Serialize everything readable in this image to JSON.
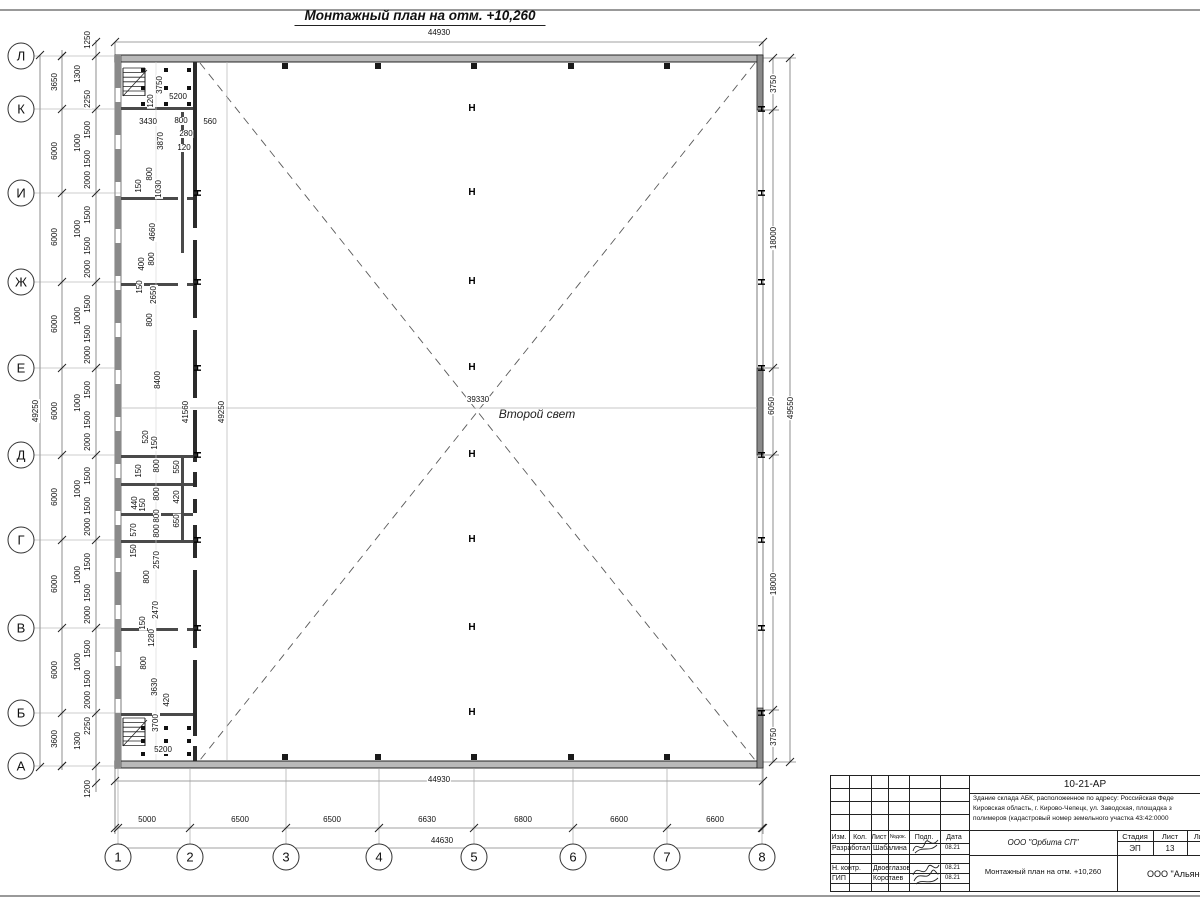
{
  "sheet": {
    "title": "Монтажный план на отм. +10,260"
  },
  "plan": {
    "hall_label": "Второй свет",
    "column_symbol": "H",
    "axis_rows": [
      {
        "label": "Л",
        "y": 56
      },
      {
        "label": "К",
        "y": 109
      },
      {
        "label": "И",
        "y": 193
      },
      {
        "label": "Ж",
        "y": 282
      },
      {
        "label": "Е",
        "y": 368
      },
      {
        "label": "Д",
        "y": 455
      },
      {
        "label": "Г",
        "y": 540
      },
      {
        "label": "В",
        "y": 628
      },
      {
        "label": "Б",
        "y": 713
      },
      {
        "label": "А",
        "y": 766
      }
    ],
    "axis_cols": [
      {
        "label": "1",
        "x": 118
      },
      {
        "label": "2",
        "x": 190
      },
      {
        "label": "3",
        "x": 286
      },
      {
        "label": "4",
        "x": 379
      },
      {
        "label": "5",
        "x": 474
      },
      {
        "label": "6",
        "x": 573
      },
      {
        "label": "7",
        "x": 667
      },
      {
        "label": "8",
        "x": 762
      }
    ],
    "dim_labels_h": [
      {
        "t": "44930",
        "x": 439,
        "y": 33
      },
      {
        "t": "5200",
        "x": 178,
        "y": 97
      },
      {
        "t": "3430",
        "x": 148,
        "y": 122
      },
      {
        "t": "800",
        "x": 181,
        "y": 121
      },
      {
        "t": "560",
        "x": 210,
        "y": 122
      },
      {
        "t": "280",
        "x": 186,
        "y": 134
      },
      {
        "t": "120",
        "x": 184,
        "y": 148
      },
      {
        "t": "39330",
        "x": 478,
        "y": 400
      },
      {
        "t": "5200",
        "x": 163,
        "y": 750
      },
      {
        "t": "44930",
        "x": 439,
        "y": 780
      },
      {
        "t": "5000",
        "x": 147,
        "y": 820
      },
      {
        "t": "6500",
        "x": 240,
        "y": 820
      },
      {
        "t": "6500",
        "x": 332,
        "y": 820
      },
      {
        "t": "6630",
        "x": 427,
        "y": 820
      },
      {
        "t": "6800",
        "x": 523,
        "y": 820
      },
      {
        "t": "6600",
        "x": 619,
        "y": 820
      },
      {
        "t": "6600",
        "x": 715,
        "y": 820
      },
      {
        "t": "44630",
        "x": 442,
        "y": 841
      }
    ],
    "dim_labels_v": [
      {
        "t": "49250",
        "x": 36,
        "y": 411
      },
      {
        "t": "3650",
        "x": 55,
        "y": 82
      },
      {
        "t": "6000",
        "x": 55,
        "y": 151
      },
      {
        "t": "6000",
        "x": 55,
        "y": 237
      },
      {
        "t": "6000",
        "x": 55,
        "y": 324
      },
      {
        "t": "6000",
        "x": 55,
        "y": 411
      },
      {
        "t": "6000",
        "x": 55,
        "y": 497
      },
      {
        "t": "6000",
        "x": 55,
        "y": 584
      },
      {
        "t": "6000",
        "x": 55,
        "y": 670
      },
      {
        "t": "3600",
        "x": 55,
        "y": 739
      },
      {
        "t": "1250",
        "x": 88,
        "y": 40
      },
      {
        "t": "1300",
        "x": 78,
        "y": 74
      },
      {
        "t": "2250",
        "x": 88,
        "y": 99
      },
      {
        "t": "1500",
        "x": 88,
        "y": 130
      },
      {
        "t": "1000",
        "x": 78,
        "y": 143
      },
      {
        "t": "1500",
        "x": 88,
        "y": 159
      },
      {
        "t": "2000",
        "x": 88,
        "y": 180
      },
      {
        "t": "1500",
        "x": 88,
        "y": 215
      },
      {
        "t": "1000",
        "x": 78,
        "y": 229
      },
      {
        "t": "1500",
        "x": 88,
        "y": 246
      },
      {
        "t": "2000",
        "x": 88,
        "y": 269
      },
      {
        "t": "1500",
        "x": 88,
        "y": 304
      },
      {
        "t": "1000",
        "x": 78,
        "y": 316
      },
      {
        "t": "1500",
        "x": 88,
        "y": 334
      },
      {
        "t": "2000",
        "x": 88,
        "y": 355
      },
      {
        "t": "1500",
        "x": 88,
        "y": 390
      },
      {
        "t": "1000",
        "x": 78,
        "y": 403
      },
      {
        "t": "1500",
        "x": 88,
        "y": 420
      },
      {
        "t": "2000",
        "x": 88,
        "y": 442
      },
      {
        "t": "1500",
        "x": 88,
        "y": 476
      },
      {
        "t": "1000",
        "x": 78,
        "y": 489
      },
      {
        "t": "1500",
        "x": 88,
        "y": 506
      },
      {
        "t": "2000",
        "x": 88,
        "y": 527
      },
      {
        "t": "1500",
        "x": 88,
        "y": 562
      },
      {
        "t": "1000",
        "x": 78,
        "y": 575
      },
      {
        "t": "1500",
        "x": 88,
        "y": 593
      },
      {
        "t": "2000",
        "x": 88,
        "y": 615
      },
      {
        "t": "1500",
        "x": 88,
        "y": 649
      },
      {
        "t": "1000",
        "x": 78,
        "y": 662
      },
      {
        "t": "1500",
        "x": 88,
        "y": 679
      },
      {
        "t": "2000",
        "x": 88,
        "y": 700
      },
      {
        "t": "2250",
        "x": 88,
        "y": 726
      },
      {
        "t": "1300",
        "x": 78,
        "y": 741
      },
      {
        "t": "1200",
        "x": 88,
        "y": 789
      },
      {
        "t": "3750",
        "x": 774,
        "y": 84
      },
      {
        "t": "18000",
        "x": 774,
        "y": 238
      },
      {
        "t": "6050",
        "x": 772,
        "y": 406
      },
      {
        "t": "49550",
        "x": 791,
        "y": 408
      },
      {
        "t": "18000",
        "x": 774,
        "y": 584
      },
      {
        "t": "3750",
        "x": 774,
        "y": 737
      },
      {
        "t": "3750",
        "x": 160,
        "y": 85
      },
      {
        "t": "120",
        "x": 151,
        "y": 101
      },
      {
        "t": "3870",
        "x": 161,
        "y": 141
      },
      {
        "t": "800",
        "x": 150,
        "y": 174
      },
      {
        "t": "150",
        "x": 139,
        "y": 186
      },
      {
        "t": "1030",
        "x": 159,
        "y": 189
      },
      {
        "t": "4660",
        "x": 153,
        "y": 232
      },
      {
        "t": "400",
        "x": 142,
        "y": 264
      },
      {
        "t": "800",
        "x": 152,
        "y": 259
      },
      {
        "t": "150",
        "x": 140,
        "y": 287
      },
      {
        "t": "2650",
        "x": 154,
        "y": 295
      },
      {
        "t": "800",
        "x": 150,
        "y": 320
      },
      {
        "t": "8400",
        "x": 158,
        "y": 380
      },
      {
        "t": "41560",
        "x": 186,
        "y": 412
      },
      {
        "t": "49250",
        "x": 222,
        "y": 412
      },
      {
        "t": "520",
        "x": 146,
        "y": 437
      },
      {
        "t": "150",
        "x": 155,
        "y": 443
      },
      {
        "t": "800",
        "x": 157,
        "y": 466
      },
      {
        "t": "550",
        "x": 177,
        "y": 467
      },
      {
        "t": "150",
        "x": 139,
        "y": 471
      },
      {
        "t": "800",
        "x": 157,
        "y": 494
      },
      {
        "t": "420",
        "x": 177,
        "y": 497
      },
      {
        "t": "440",
        "x": 135,
        "y": 503
      },
      {
        "t": "150",
        "x": 143,
        "y": 505
      },
      {
        "t": "800",
        "x": 157,
        "y": 516
      },
      {
        "t": "650",
        "x": 177,
        "y": 521
      },
      {
        "t": "570",
        "x": 134,
        "y": 530
      },
      {
        "t": "800",
        "x": 157,
        "y": 531
      },
      {
        "t": "150",
        "x": 134,
        "y": 551
      },
      {
        "t": "2570",
        "x": 157,
        "y": 560
      },
      {
        "t": "800",
        "x": 147,
        "y": 577
      },
      {
        "t": "2470",
        "x": 156,
        "y": 610
      },
      {
        "t": "150",
        "x": 143,
        "y": 623
      },
      {
        "t": "1280",
        "x": 152,
        "y": 638
      },
      {
        "t": "800",
        "x": 144,
        "y": 663
      },
      {
        "t": "3630",
        "x": 155,
        "y": 687
      },
      {
        "t": "420",
        "x": 167,
        "y": 700
      },
      {
        "t": "3700",
        "x": 156,
        "y": 723
      }
    ],
    "center_columns": {
      "x": 472,
      "rows": [
        109,
        193,
        282,
        368,
        455,
        540,
        628,
        713
      ]
    },
    "right_wall_columns": {
      "x": 760,
      "rows": [
        109,
        193,
        282,
        368,
        455,
        540,
        628,
        713
      ]
    },
    "inner_wall_columns": {
      "x": 196,
      "rows": [
        193,
        282,
        368,
        455,
        540,
        628
      ]
    },
    "wall_squares": {
      "xs": [
        285,
        378,
        474,
        571,
        667
      ],
      "top_y": 66,
      "bottom_y": 757
    }
  },
  "titleblock": {
    "doc_number": "10-21-АР",
    "address_lines": [
      "Здание склада АБК, расположенное по адресу: Российская Феде",
      "Кировская область, г. Кирово-Чепецк, ул. Заводская, площадка з",
      "полимеров (кадастровый номер земельного участка 43:42:0000"
    ],
    "rev_headers": [
      "Изм.",
      "Кол.",
      "Лист",
      "№док.",
      "Подп.",
      "Дата"
    ],
    "stage_headers": [
      "Стадия",
      "Лист",
      "Листов"
    ],
    "stage_values": [
      "ЭП",
      "13",
      "1"
    ],
    "people": [
      {
        "role": "Разработал",
        "name": "Шабалина",
        "date": "08.21"
      },
      {
        "role": "Н. контр.",
        "name": "Двоеглазов",
        "date": "08.21"
      },
      {
        "role": "ГИП",
        "name": "Коротаев",
        "date": "08.21"
      }
    ],
    "org": "ООО \"Орбита СП\"",
    "sheet_name": "Монтажный план на отм. +10,260",
    "org2": "ООО \"Альянс"
  }
}
